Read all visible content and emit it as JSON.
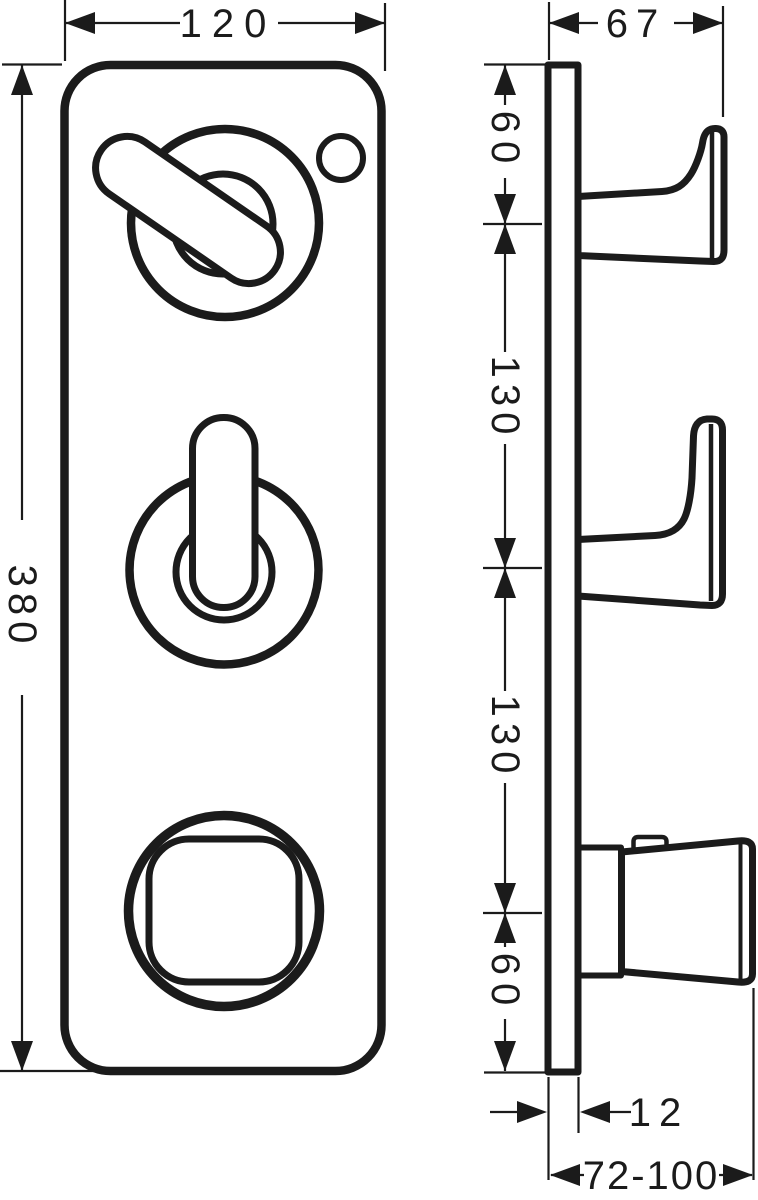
{
  "drawing": {
    "type": "technical-dimension-drawing",
    "subject": "3-handle concealed mixer trim plate, front and side elevation",
    "colors": {
      "line": "#1b1b1b",
      "background": "#ffffff"
    },
    "dims": {
      "front_width": "120",
      "front_height": "380",
      "side_depth": "67",
      "side_top_offset": "60",
      "side_span_upper": "130",
      "side_span_lower": "130",
      "side_bottom_offset": "60",
      "plate_thickness": "12",
      "installation_depth_range": "72-100"
    }
  }
}
